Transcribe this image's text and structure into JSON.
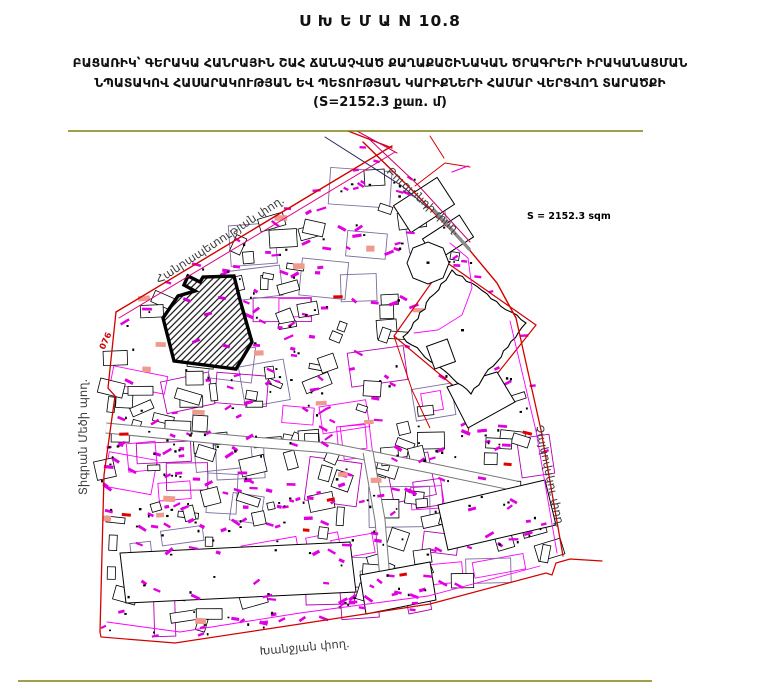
{
  "header": {
    "title": "Ս Խ Ե Մ Ա N 10.8",
    "subtitle_line1": "ԲԱՑԱՌԻԿ՝ ԳԵՐԱԿԱ ՀԱՆՐԱՅԻՆ ՇԱՀ ՃԱՆԱՉՎԱԾ ՔԱՂԱՔԱՇԻՆԱԿԱՆ ԾՐԱԳՐԵՐԻ ԻՐԱԿԱՆԱՑՄԱՆ",
    "subtitle_line2": "ՆՊԱՏԱԿՈՎ ՀԱՍԱՐԱԿՈՒԹՅԱՆ ԵՎ ՊԵՏՈՒԹՅԱՆ ԿԱՐԻՔՆԵՐԻ ՀԱՄԱՐ ՎԵՐՑՎՈՂ ՏԱՐԱԾՔԻ",
    "area_line": "(S=2152.3 քառ. մ)"
  },
  "map": {
    "area_label": "S = 2152.3 sqm",
    "parcel_code": "076",
    "streets": {
      "republic": "Հանրապետության փող.",
      "buzand": "Բուզանդի փող.",
      "tigran_mets": "Տիգրան Մեծի պող.",
      "tchaikovsky": "Չայկովսկու փող.",
      "khanjyan": "Խանջյան փող."
    },
    "colors": {
      "frame_olive": "#82800f",
      "street_red": "#d40000",
      "parcel_magenta": "#ff00ff",
      "annotation_magenta": "#e000e0",
      "highlight_salmon": "#ef9a8f"
    }
  }
}
